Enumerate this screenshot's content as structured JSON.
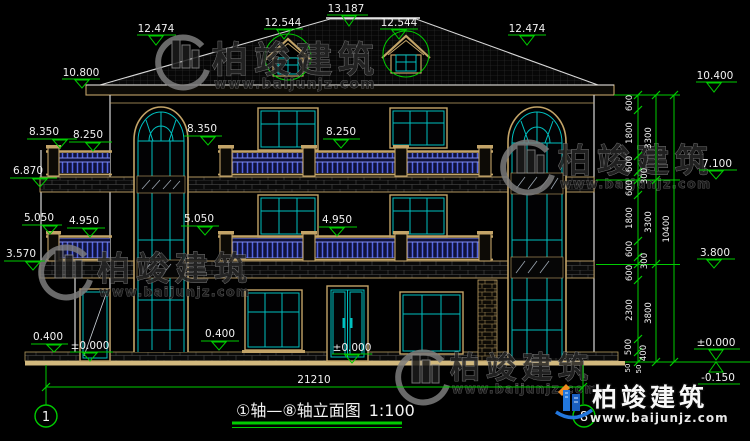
{
  "drawing": {
    "type": "house-elevation-cad",
    "background": "#000000"
  },
  "title": {
    "name": "①轴—⑧轴立面图",
    "scale": "1:100"
  },
  "axis": {
    "left": "1",
    "right": "8"
  },
  "overall": {
    "width": "21210"
  },
  "elevation_marks": {
    "top": [
      "13.187",
      "12.544",
      "12.544",
      "12.474",
      "12.474",
      "10.800",
      "10.400"
    ],
    "left": [
      "8.350",
      "8.250",
      "6.870",
      "5.050",
      "4.950",
      "3.570",
      "0.400",
      "±0.000"
    ],
    "center": [
      "8.350",
      "8.250",
      "5.050",
      "4.950",
      "0.400",
      "±0.000"
    ],
    "right": [
      "7.100",
      "3.800",
      "±0.000",
      "-0.150"
    ]
  },
  "dim_chain": {
    "inner": [
      "600",
      "1800",
      "600",
      "300",
      "600",
      "1800",
      "600",
      "300",
      "600",
      "2300",
      "500",
      "400",
      "50",
      "50"
    ],
    "middle": [
      "3300",
      "3300",
      "3800"
    ],
    "outer": [
      "10400"
    ]
  },
  "brand": {
    "name": "柏竣建筑",
    "url": "www.baijunjz.com"
  },
  "colors": {
    "dimension_green": "#00cc00",
    "frame_tan": "#c3a468",
    "mullion_cyan": "#00c0c0",
    "railing_blue": "#4b5ad8",
    "logo_blue": "#2277dd",
    "logo_orange": "#f08a1e"
  }
}
